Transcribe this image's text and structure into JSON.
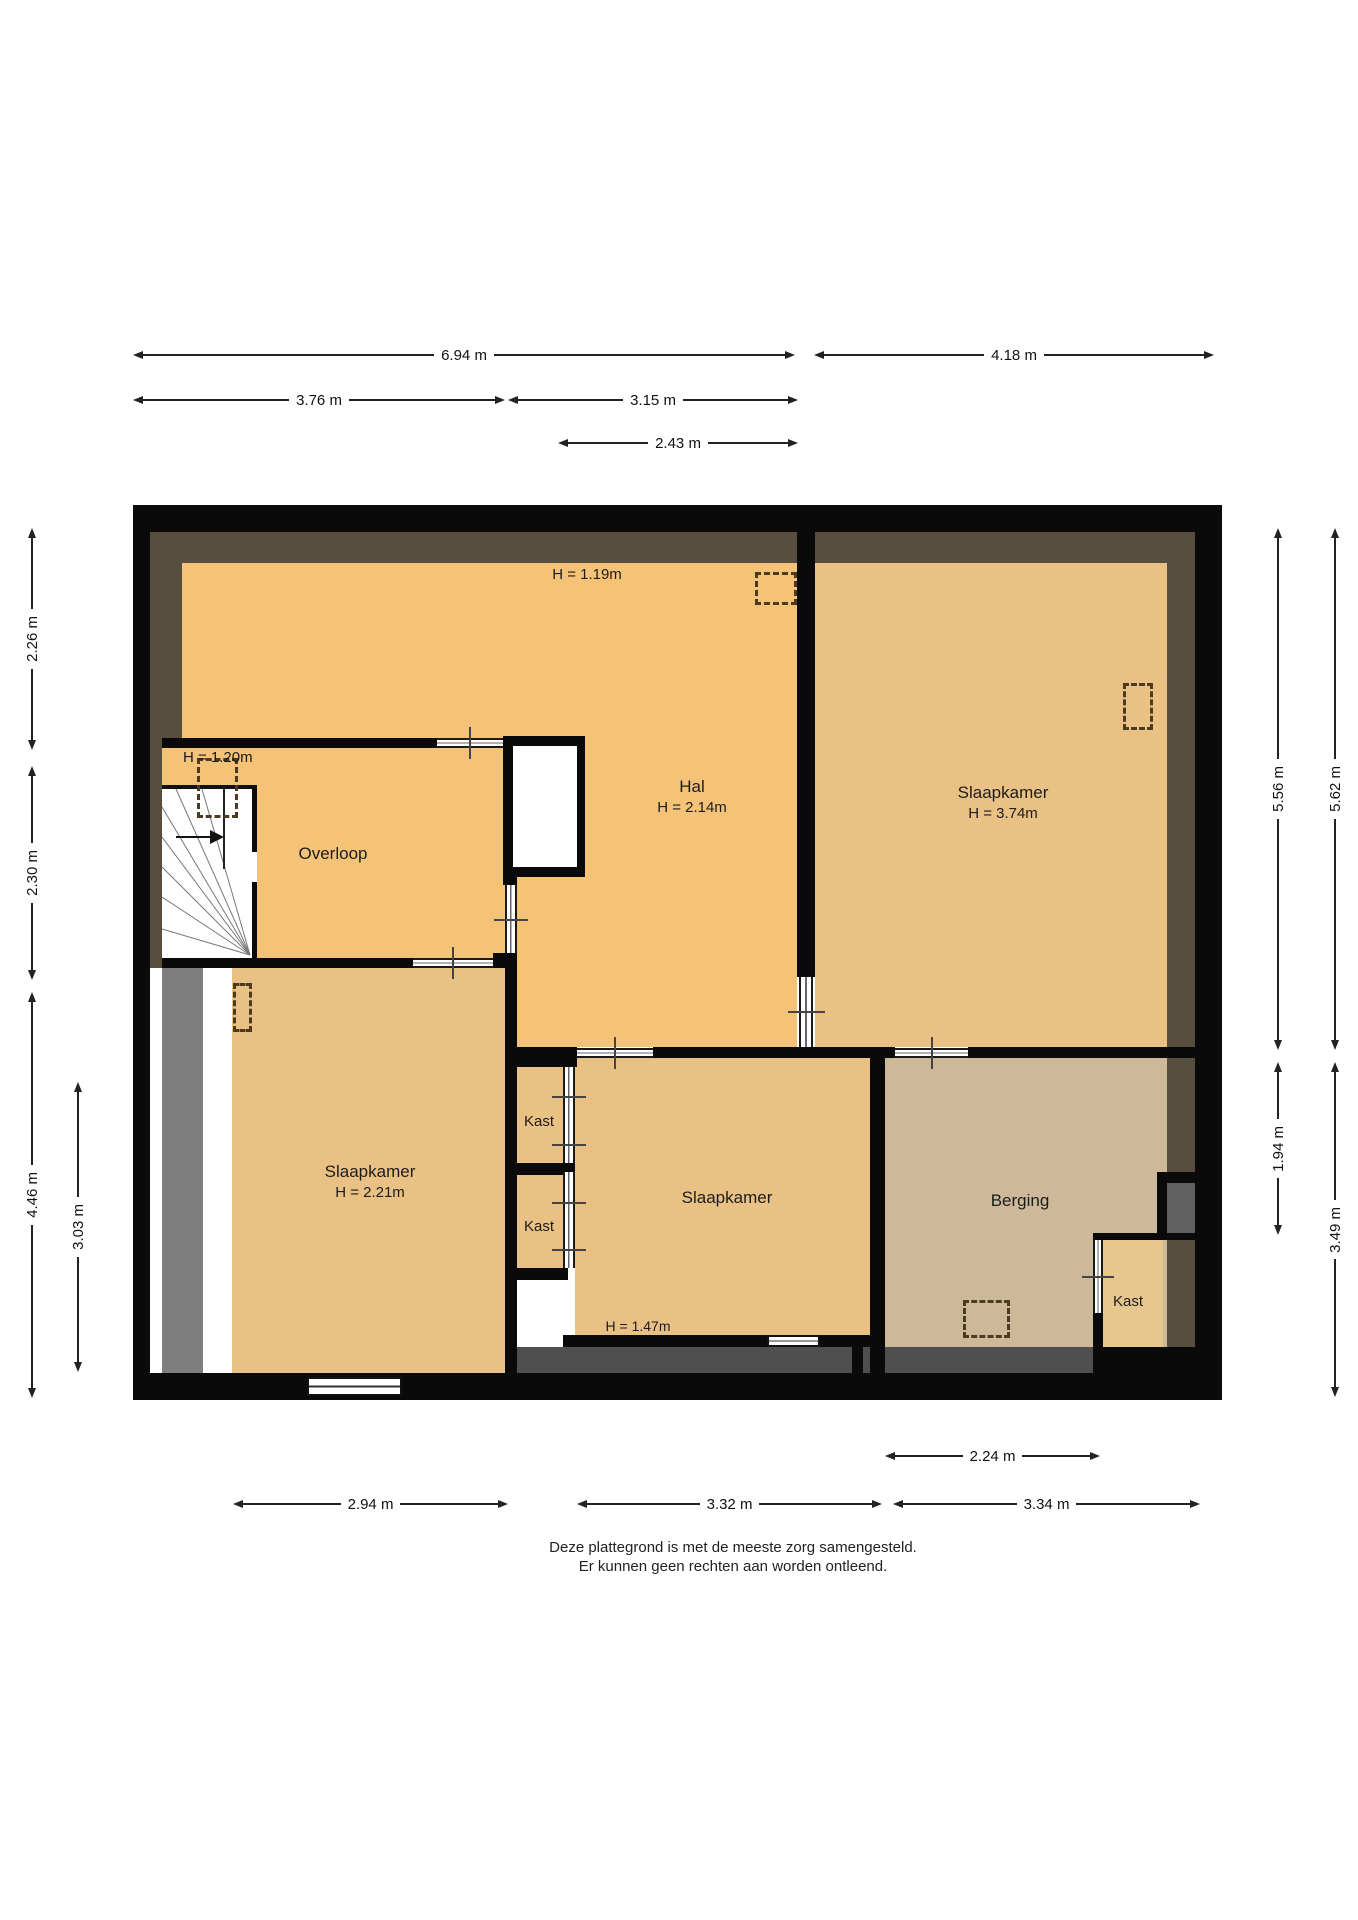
{
  "floorplan": {
    "rooms": {
      "overloop": {
        "name": "Overloop"
      },
      "hal": {
        "name": "Hal",
        "height": "H = 2.14m"
      },
      "slaapkamer_rechts": {
        "name": "Slaapkamer",
        "height": "H = 3.74m"
      },
      "slaapkamer_links": {
        "name": "Slaapkamer",
        "height": "H = 2.21m"
      },
      "slaapkamer_midden": {
        "name": "Slaapkamer"
      },
      "kast_1": {
        "name": "Kast"
      },
      "kast_2": {
        "name": "Kast"
      },
      "kast_rechts": {
        "name": "Kast"
      },
      "berging": {
        "name": "Berging"
      }
    },
    "notes": {
      "attic_height": "H = 1.19m",
      "stair_height": "H = 1.20m",
      "low_ceiling": "H = 1.47m"
    },
    "dims": {
      "top_total_left": "6.94 m",
      "top_total_right": "4.18 m",
      "top_overloop": "3.76 m",
      "top_hal": "3.15 m",
      "top_hal_inner": "2.43 m",
      "bottom_berging": "2.24 m",
      "bottom_left": "2.94 m",
      "bottom_middle": "3.32 m",
      "bottom_right": "3.34 m",
      "left_top": "2.26 m",
      "left_middle": "2.30 m",
      "left_bottom": "4.46 m",
      "left_inner": "3.03 m",
      "right_top_inner": "5.56 m",
      "right_berging": "1.94 m",
      "right_top_outer": "5.62 m",
      "right_bottom": "3.49 m"
    },
    "footer": {
      "line1": "Deze plattegrond is met de meeste zorg samengesteld.",
      "line2": "Er kunnen geen rechten aan worden ontleend."
    },
    "colors": {
      "room_orange": "#F5C377",
      "room_tan": "#EAC184",
      "room_berging": "#CDB99A",
      "room_kast_rechts": "#E6C78D",
      "roof_band": "#584E3E",
      "wall": "#0A0A0A",
      "gray_strip": "#7E7E7E",
      "gray_dark": "#4F4F4F"
    }
  }
}
